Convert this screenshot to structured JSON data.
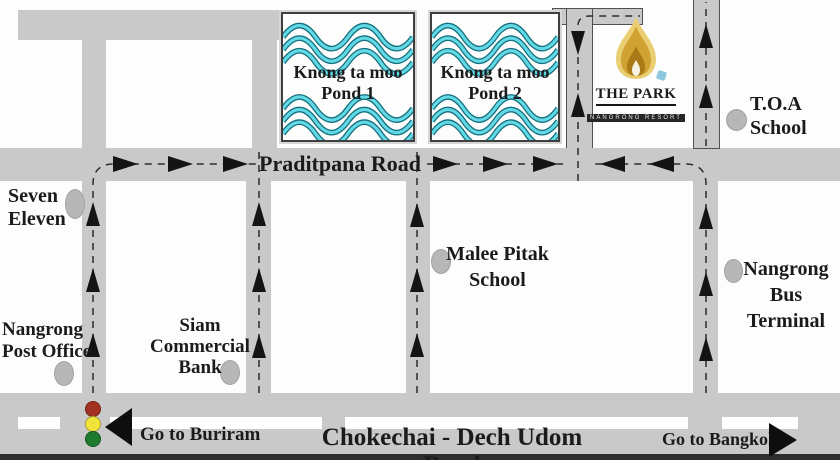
{
  "map": {
    "roads": {
      "praditpana_label": "Praditpana Road",
      "chokechai_label": "Chokechai - Dech Udom Road"
    },
    "directions": {
      "buriram_label": "Go to Buriram",
      "bangkok_label": "Go to Bangkok"
    },
    "ponds": {
      "pond1": {
        "line1": "Knong ta moo",
        "line2": "Pond 1"
      },
      "pond2": {
        "line1": "Knong ta moo",
        "line2": "Pond 2"
      }
    },
    "resort": {
      "title": "THE PARK",
      "subtitle": "NANGRONG RESORT"
    },
    "places": {
      "seven_eleven": {
        "line1": "Seven",
        "line2": "Eleven"
      },
      "toa_school": {
        "line1": "T.O.A",
        "line2": "School"
      },
      "malee_pitak": {
        "line1": "Malee Pitak",
        "line2": "School"
      },
      "bus_terminal": {
        "line1": "Nangrong",
        "line2": "Bus Terminal"
      },
      "siam_bank": {
        "line1": "Siam",
        "line2": "Commercial",
        "line3": "Bank"
      },
      "post_office": {
        "line1": "Nangrong",
        "line2": "Post Office"
      }
    },
    "colors": {
      "road_gray": "#c9c9c9",
      "wave_dark": "#15707f",
      "wave_light": "#63d9e6",
      "flame_outer": "#e9cf72",
      "flame_mid": "#cfa231",
      "traffic_red": "#a33121",
      "traffic_yellow": "#efe33c",
      "traffic_green": "#1d7b2e"
    }
  }
}
